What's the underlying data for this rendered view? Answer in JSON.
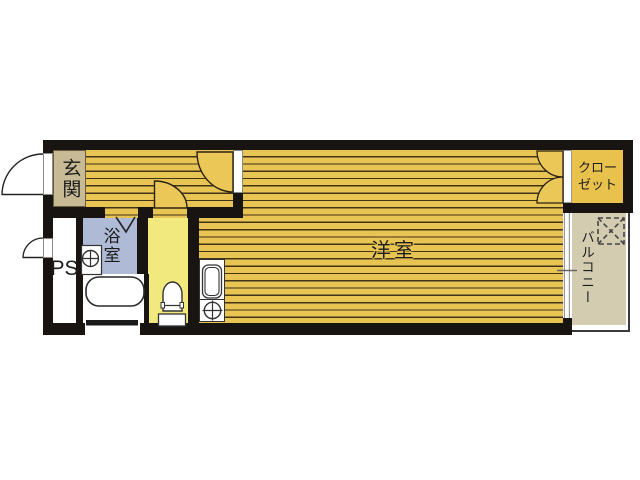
{
  "labels": {
    "genkan": "玄関",
    "ps": "PS",
    "bathroom": "浴室",
    "western_room": "洋室",
    "closet_line1": "クロー",
    "closet_line2": "ゼット",
    "balcony": "バルコニー"
  },
  "colors": {
    "wall": "#171411",
    "floor_fill": "#e8c553",
    "floor_stripe": "#40341a",
    "door_swing_fill": "#eac757",
    "genkan": "#c8ba94",
    "bathroom": "#aebad6",
    "toilet_room": "#f1e97e",
    "closet": "#e8c24d",
    "balcony": "#d4ccb0",
    "fixture_line": "#333333"
  },
  "icons": [
    "entrance-door-swing",
    "ps-door-swing",
    "room-door-swing",
    "toilet-door-swing",
    "closet-double-door-swing",
    "bathroom-folding-door",
    "washbasin",
    "bathtub",
    "toilet",
    "kitchen-sink",
    "stove-burner",
    "washing-machine-pan",
    "sliding-window"
  ]
}
